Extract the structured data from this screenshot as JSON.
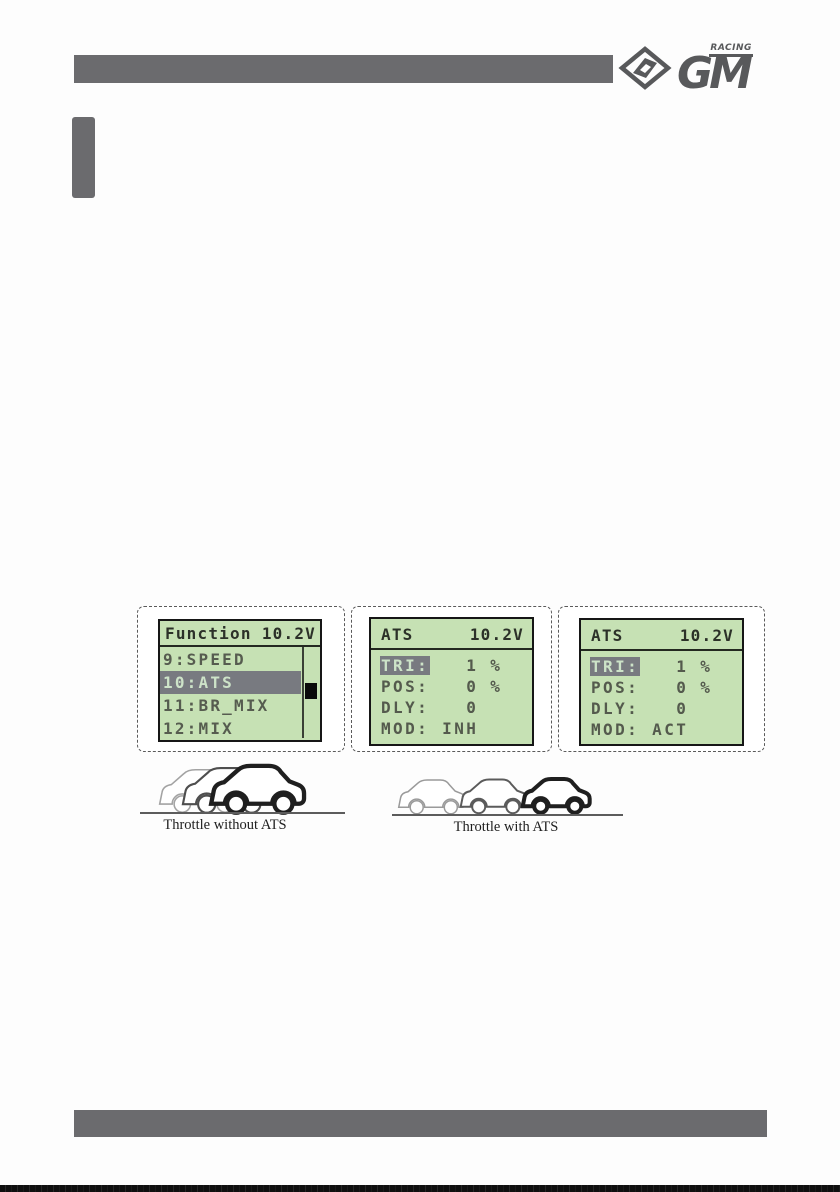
{
  "logo": {
    "gm": "GM",
    "racing": "RACING"
  },
  "screens": [
    {
      "title_left": "Function",
      "title_right": "10.2V",
      "items": [
        {
          "label": "9:SPEED"
        },
        {
          "label": "10:ATS"
        },
        {
          "label": "11:BR_MIX"
        },
        {
          "label": "12:MIX"
        }
      ]
    },
    {
      "title_left": "ATS",
      "title_right": "10.2V",
      "rows": [
        {
          "label": "TRI:",
          "value": "   1 %"
        },
        {
          "label": "POS:",
          "value": "   0 %"
        },
        {
          "label": "DLY:",
          "value": "   0"
        },
        {
          "label": "MOD:",
          "value": " INH"
        }
      ]
    },
    {
      "title_left": "ATS",
      "title_right": "10.2V",
      "rows": [
        {
          "label": "TRI:",
          "value": "   1 %"
        },
        {
          "label": "POS:",
          "value": "   0 %"
        },
        {
          "label": "DLY:",
          "value": "   0"
        },
        {
          "label": "MOD:",
          "value": " ACT"
        }
      ]
    }
  ],
  "figures": [
    {
      "caption": "Throttle without ATS"
    },
    {
      "caption": "Throttle with ATS"
    }
  ],
  "colors": {
    "lcd_green": "#c6e1b4",
    "lcd_highlight": "#787a80",
    "bar_gray": "#6b6b6e",
    "logo_gray": "#58595b"
  }
}
